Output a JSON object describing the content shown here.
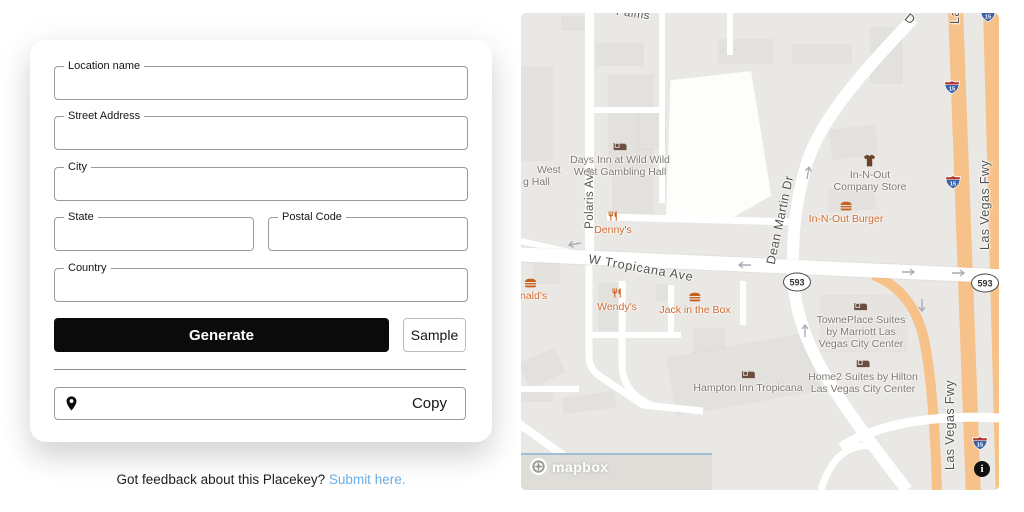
{
  "form": {
    "fields": [
      {
        "label": "Location name",
        "value": ""
      },
      {
        "label": "Street Address",
        "value": ""
      },
      {
        "label": "City",
        "value": ""
      },
      {
        "label": "State",
        "value": ""
      },
      {
        "label": "Postal Code",
        "value": ""
      },
      {
        "label": "Country",
        "value": ""
      }
    ],
    "generate_label": "Generate",
    "sample_label": "Sample",
    "copy_label": "Copy",
    "result_value": ""
  },
  "feedback": {
    "text": "Got feedback about this Placekey? ",
    "link": "Submit here.",
    "link_color": "#68ade6"
  },
  "map": {
    "streets": {
      "palms": "Palms",
      "polaris": "Polaris Ave",
      "tropicana": "W Tropicana Ave",
      "dean_martin": "Dean Martin Dr",
      "dean_martin_partial": "D",
      "las_vegas_fwy": "Las Vegas Fwy"
    },
    "shields": {
      "interstate": "15",
      "state_route": "593"
    },
    "pois": [
      {
        "id": "days-inn",
        "type": "lodging",
        "lines": [
          "Days Inn at Wild Wild",
          "West Gambling Hall"
        ]
      },
      {
        "id": "gambling-hall-partial",
        "type": "lodging",
        "lines": [
          "West",
          "g Hall"
        ]
      },
      {
        "id": "dennys",
        "type": "restaurant",
        "lines": [
          "Denny's"
        ]
      },
      {
        "id": "in-n-out-company-store",
        "type": "shop",
        "lines": [
          "In-N-Out",
          "Company Store"
        ]
      },
      {
        "id": "in-n-out-burger",
        "type": "fastfood",
        "lines": [
          "In-N-Out Burger"
        ]
      },
      {
        "id": "mcdonalds-partial",
        "type": "fastfood",
        "lines": [
          "nald's"
        ]
      },
      {
        "id": "wendys",
        "type": "restaurant",
        "lines": [
          "Wendy's"
        ]
      },
      {
        "id": "jack-in-the-box",
        "type": "fastfood",
        "lines": [
          "Jack in the Box"
        ]
      },
      {
        "id": "towneplace-suites",
        "type": "lodging",
        "lines": [
          "TownePlace Suites",
          "by Marriott Las",
          "Vegas City Center"
        ]
      },
      {
        "id": "home2-suites",
        "type": "lodging",
        "lines": [
          "Home2 Suites by Hilton",
          "Las Vegas City Center"
        ]
      },
      {
        "id": "hampton-inn",
        "type": "lodging",
        "lines": [
          "Hampton Inn Tropicana"
        ]
      }
    ],
    "attribution": {
      "wordmark": "mapbox",
      "info_label": "i"
    },
    "colors": {
      "background": "#eae8e4",
      "road": "#ffffff",
      "freeway": "#f7c289",
      "building": "#e3e1dd",
      "poi_food": "#cf6a2e",
      "poi_lodging": "#7e7970",
      "street_label": "#54524e"
    }
  }
}
